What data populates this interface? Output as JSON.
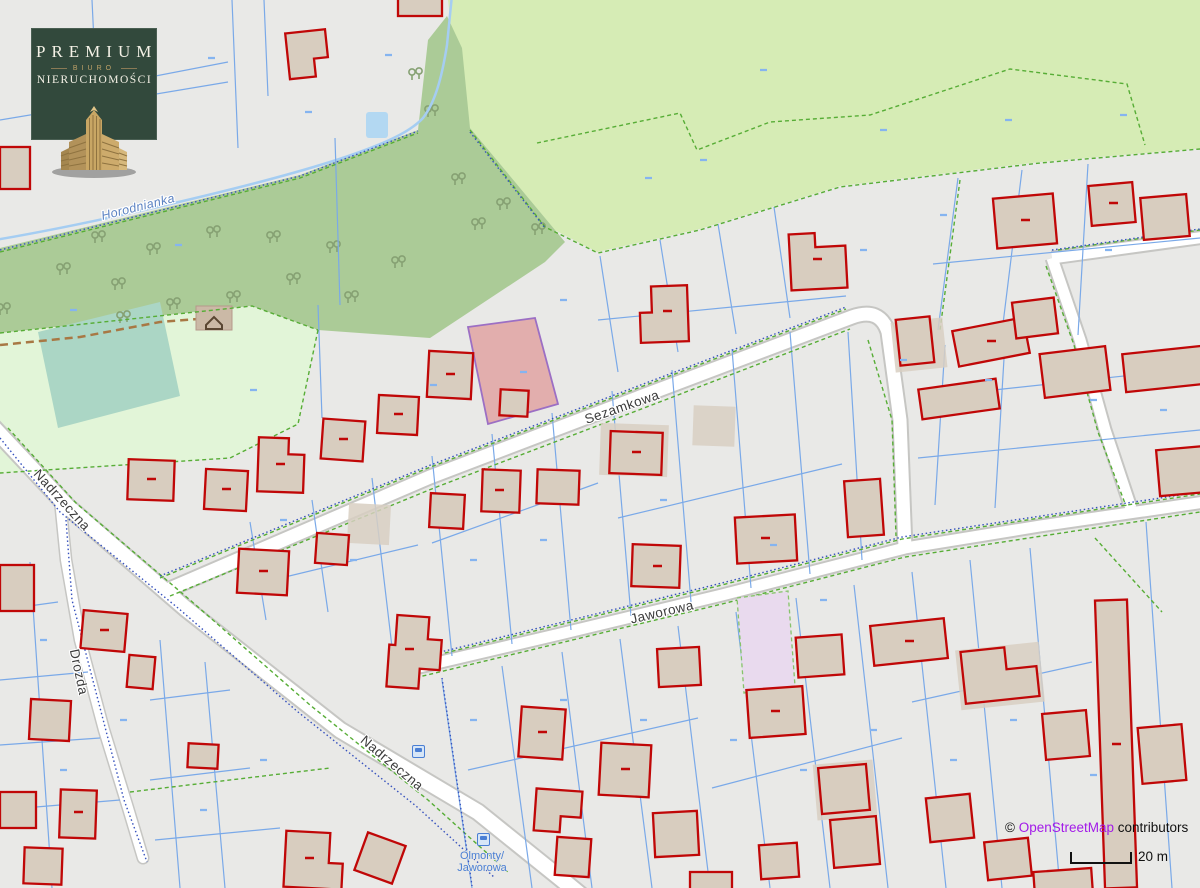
{
  "map": {
    "street_labels": [
      {
        "id": "sezamkowa",
        "text": "Sezamkowa"
      },
      {
        "id": "jaworowa",
        "text": "Jaworowa"
      },
      {
        "id": "nadrzeczna_upper",
        "text": "Nadrzeczna"
      },
      {
        "id": "nadrzeczna_lower",
        "text": "Nadrzeczna"
      },
      {
        "id": "drozda",
        "text": "Drozda"
      }
    ],
    "water_label": "Horodnianka",
    "bus_stop": {
      "line1": "Olmonty/",
      "line2": "Jaworowa"
    },
    "attribution": {
      "copyright": "© ",
      "link": "OpenStreetMap",
      "suffix": " contributors"
    },
    "scale": {
      "label": "20 m"
    }
  },
  "logo": {
    "title": "PREMIUM",
    "subtitle": "BIURO",
    "subtitle2": "NIERUCHOMOŚCI"
  },
  "colors": {
    "brand_green": "#32493c",
    "brand_gold": "#c3a467",
    "building_outline_red": "#c00707",
    "highlight_parcel": "#d95c5c",
    "osm_link_purple": "#a21ae8",
    "forest_green": "#abcb97",
    "meadow_green": "#d6ecb5",
    "park_green": "#e2f5d8",
    "pitch_teal": "#abd6c5"
  }
}
